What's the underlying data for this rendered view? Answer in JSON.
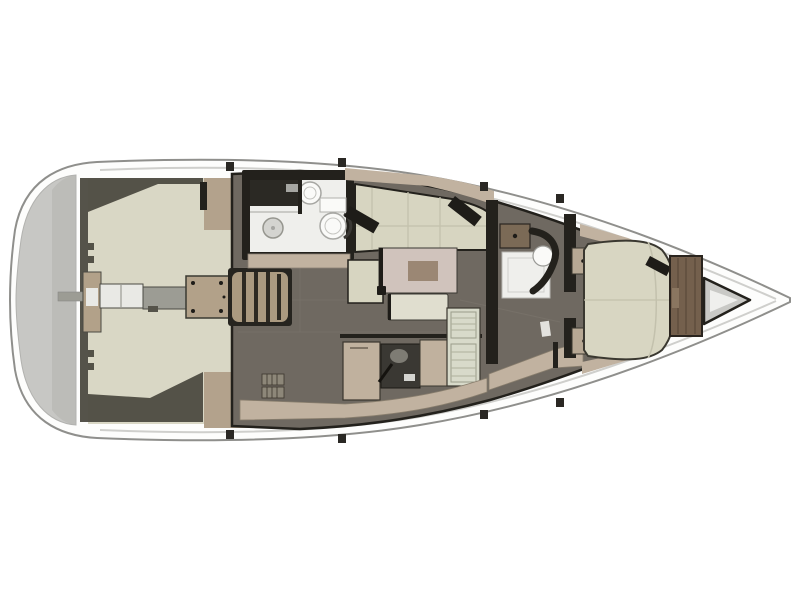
{
  "diagram": {
    "subject": "sailing-yacht-interior-floor-plan-top-view",
    "orientation": {
      "bow": "right",
      "stern": "left"
    },
    "areas": [
      "swim-platform",
      "cockpit",
      "cockpit-table",
      "companionway-steps",
      "aft-head",
      "salon",
      "salon-table",
      "galley",
      "forward-head",
      "v-berth-cabin",
      "wardrobe",
      "anchor-locker"
    ]
  },
  "colors": {
    "background": "#ffffff",
    "hull_fill": "#fdfdfc",
    "hull_outline": "#8f8f8c",
    "toe_rail": "#cfcfcc",
    "platform": "#c7c7c4",
    "platform_dark": "#b2b2af",
    "transom": "#55534a",
    "cockpit_sole": "#d9d7c5",
    "side_deck": "#545248",
    "coaming": "#b3a28c",
    "pedestal": "#b2a189",
    "table_white": "#e9e9e5",
    "step_gray": "#9c9c94",
    "step_tread": "#ab9a80",
    "step_gap": "#2e2a22",
    "step_well": "#26241f",
    "wall_dark": "#23211c",
    "head_floor": "#efefec",
    "counter_dark": "#2b2924",
    "fixture_white": "#fafaf8",
    "fixture_gray": "#d4d4d0",
    "fixture_line": "#a6a6a2",
    "floor": "#6f6961",
    "floor_line": "#7d776e",
    "sofa": "#d7d5c1",
    "seam": "#c3c1ad",
    "deck_band": "#c1b2a0",
    "accent_dark": "#1e1c18",
    "table_top": "#d0c3bc",
    "table_inlay": "#9b8774",
    "bench": "#e0decf",
    "cabinet": "#c0b19e",
    "stove": "#3a3833",
    "pot": "#7e7c74",
    "drainer": "#d8daca",
    "drainer_line": "#aeb09c",
    "locker_rib": "#8d8779",
    "vanity": "#7b6a56",
    "wardrobe": "#74604d",
    "slat": "#5a4a3a",
    "berth": "#d8d6c2",
    "nightstand": "#b7a894",
    "anchor_fill": "#c9c9c6",
    "anchor_inner": "#efefed",
    "tick": "#2a2824"
  }
}
